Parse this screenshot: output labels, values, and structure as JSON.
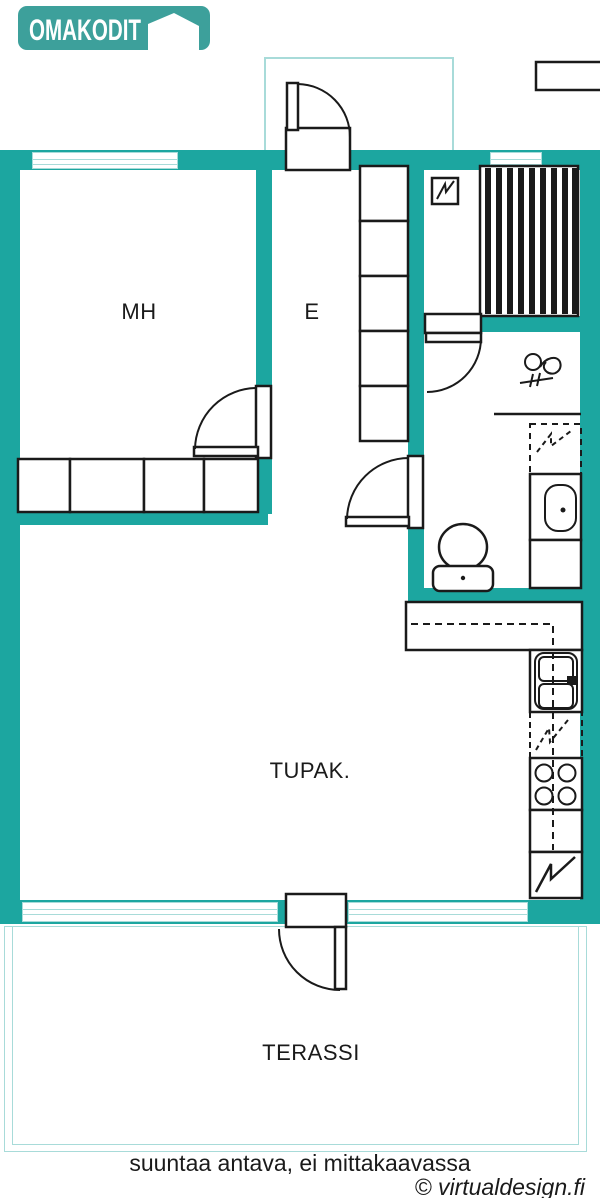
{
  "logo": {
    "brand": "OMAKODIT"
  },
  "plan": {
    "rooms": {
      "mh": {
        "label": "MH"
      },
      "e": {
        "label": "E"
      },
      "tupak": {
        "label": "TUPAK."
      },
      "terassi": {
        "label": "TERASSI"
      }
    }
  },
  "footer": {
    "disclaimer": "suuntaa antava, ei mittakaavassa",
    "credit": "© virtualdesign.fi"
  },
  "colors": {
    "wall": "#1CA6A0",
    "window": "#A8DBD9",
    "logo": "#3DA09B",
    "line": "#1A1A1A"
  }
}
